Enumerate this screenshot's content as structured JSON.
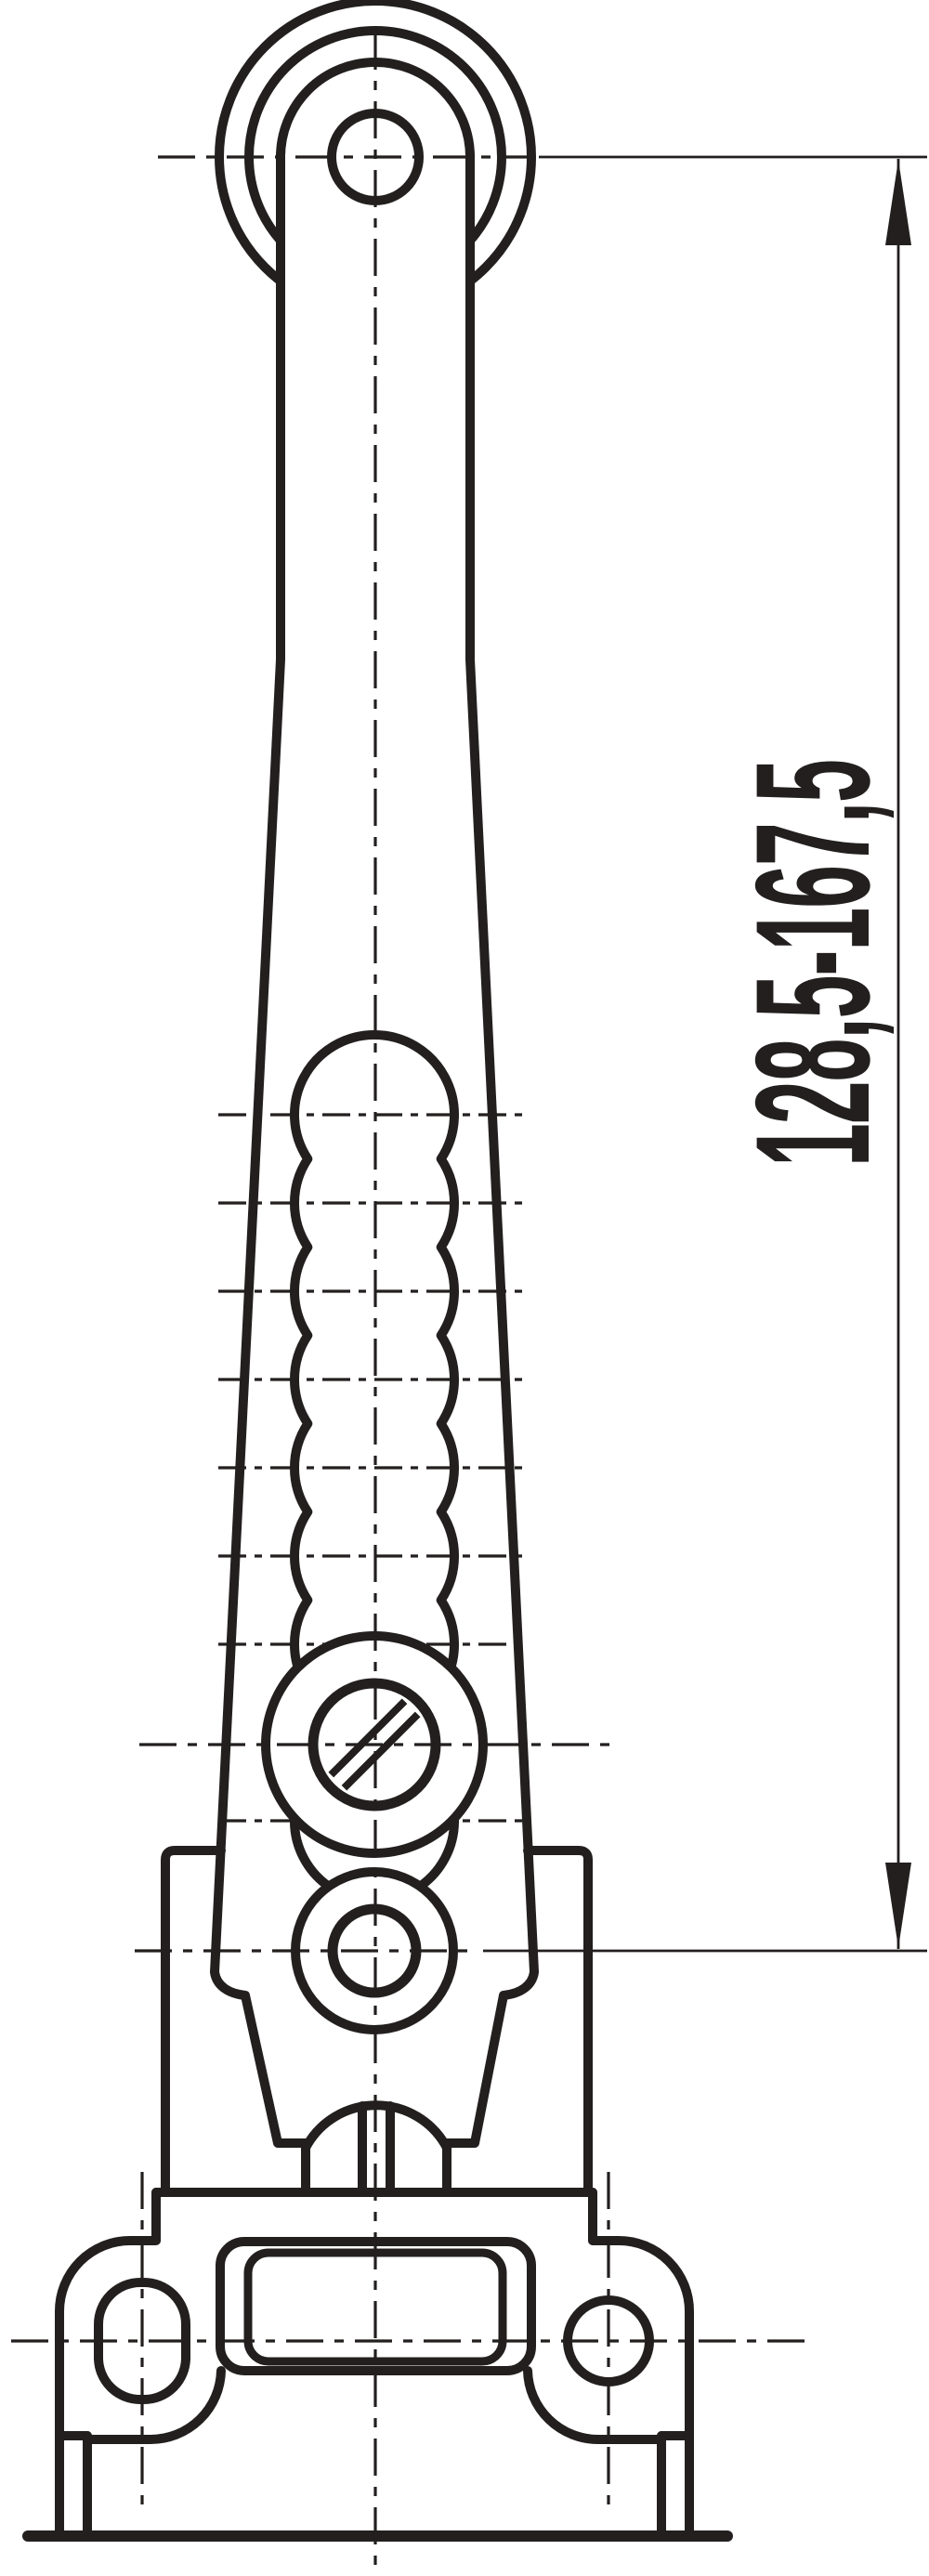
{
  "drawing": {
    "kind": "technical-line-drawing",
    "subject": "adjustable-roller-lever-limit-switch-actuator",
    "dimension": {
      "label": "128,5-167,5"
    },
    "colors": {
      "ink": "#231f1f",
      "background": "#ffffff"
    }
  }
}
